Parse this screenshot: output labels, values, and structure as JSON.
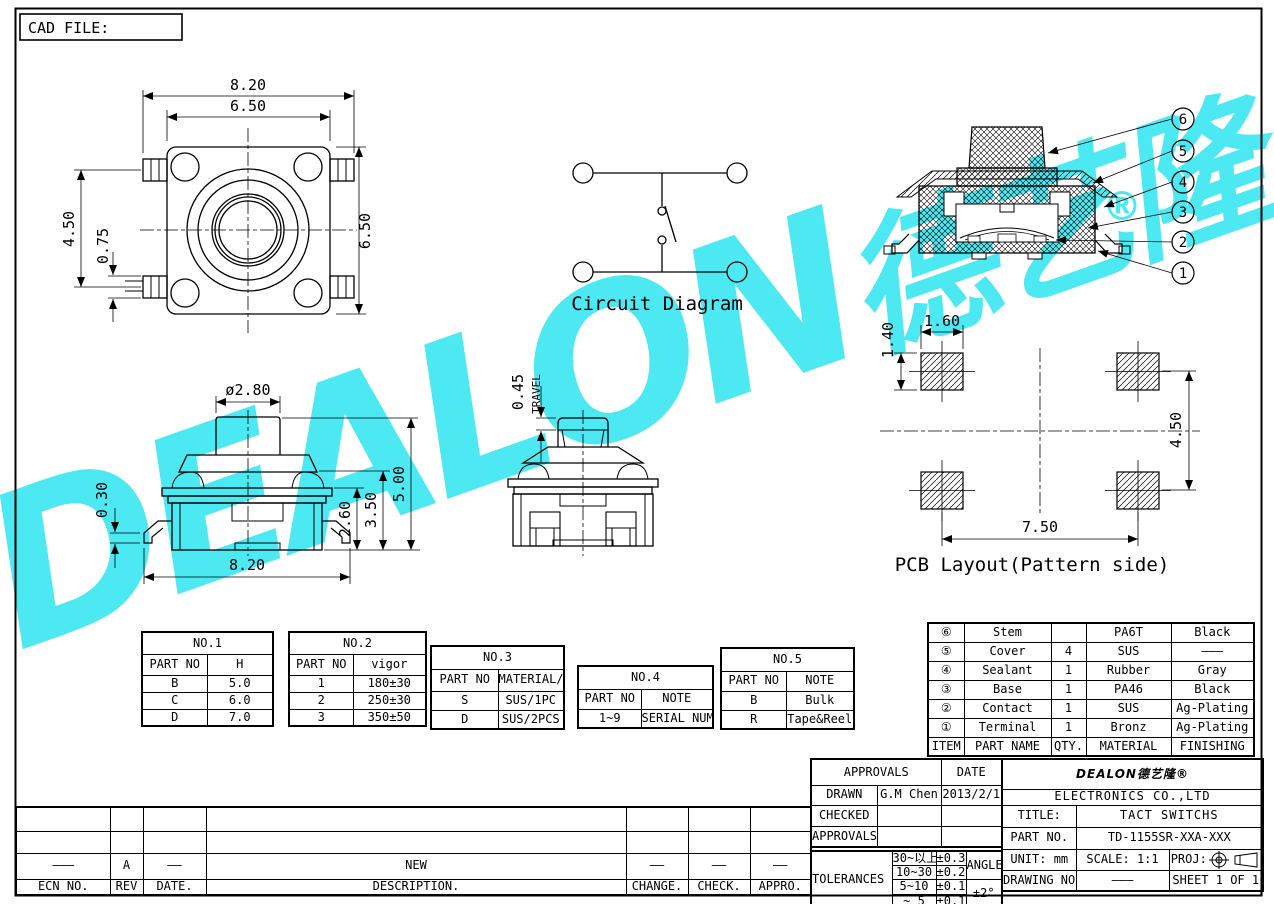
{
  "sheet": {
    "cad_file_label": "CAD FILE:"
  },
  "watermark": {
    "brand": "DEALON",
    "cjk": "德艺隆",
    "registered": "®",
    "color": "#4de9f2"
  },
  "top_view": {
    "dim_820": "8.20",
    "dim_650_top": "6.50",
    "dim_450": "4.50",
    "dim_075": "0.75",
    "dim_650_right": "6.50"
  },
  "circuit": {
    "label": "Circuit Diagram"
  },
  "section": {
    "balloons": [
      "6",
      "5",
      "4",
      "3",
      "2",
      "1"
    ]
  },
  "front_view": {
    "dim_dia": "ø2.80",
    "dim_030": "0.30",
    "dim_820": "8.20",
    "dim_260": "2.60",
    "dim_350": "3.50",
    "dim_500": "5.00"
  },
  "travel_view": {
    "dim_045": "0.45",
    "travel_label": "TRAVEL"
  },
  "pcb": {
    "label": "PCB Layout(Pattern side)",
    "dim_160": "1.60",
    "dim_140": "1.40",
    "dim_450": "4.50",
    "dim_750": "7.50"
  },
  "no1": {
    "title": "NO.1",
    "col1": "PART NO",
    "col2": "H",
    "rows": [
      [
        "B",
        "5.0"
      ],
      [
        "C",
        "6.0"
      ],
      [
        "D",
        "7.0"
      ]
    ]
  },
  "no2": {
    "title": "NO.2",
    "col1": "PART NO",
    "col2": "vigor",
    "rows": [
      [
        "1",
        "180±30"
      ],
      [
        "2",
        "250±30"
      ],
      [
        "3",
        "350±50"
      ]
    ]
  },
  "no3": {
    "title": "NO.3",
    "col1": "PART NO",
    "col2": "MATERIAL/QTY",
    "rows": [
      [
        "S",
        "SUS/1PC"
      ],
      [
        "D",
        "SUS/2PCS"
      ]
    ]
  },
  "no4": {
    "title": "NO.4",
    "col1": "PART NO",
    "col2": "NOTE",
    "rows": [
      [
        "1~9",
        "SERIAL NUMBER"
      ]
    ]
  },
  "no5": {
    "title": "NO.5",
    "col1": "PART NO",
    "col2": "NOTE",
    "rows": [
      [
        "B",
        "Bulk"
      ],
      [
        "R",
        "Tape&Reel"
      ]
    ]
  },
  "bom": {
    "rows": [
      {
        "item": "⑥",
        "name": "Stem",
        "qty": "",
        "material": "PA6T",
        "finishing": "Black"
      },
      {
        "item": "⑤",
        "name": "Cover",
        "qty": "4",
        "material": "SUS",
        "finishing": "———"
      },
      {
        "item": "④",
        "name": "Sealant",
        "qty": "1",
        "material": "Rubber",
        "finishing": "Gray"
      },
      {
        "item": "③",
        "name": "Base",
        "qty": "1",
        "material": "PA46",
        "finishing": "Black"
      },
      {
        "item": "②",
        "name": "Contact",
        "qty": "1",
        "material": "SUS",
        "finishing": "Ag-Plating"
      },
      {
        "item": "①",
        "name": "Terminal",
        "qty": "1",
        "material": "Bronz",
        "finishing": "Ag-Plating"
      }
    ],
    "footer": {
      "item": "ITEM",
      "name": "PART NAME",
      "qty": "QTY.",
      "material": "MATERIAL",
      "finishing": "FINISHING"
    }
  },
  "title_block": {
    "approvals_header": "APPROVALS",
    "date_header": "DATE",
    "drawn_label": "DRAWN",
    "drawn_name": "G.M Chen",
    "drawn_date": "2013/2/1",
    "checked_label": "CHECKED",
    "approvals_label": "APPROVALS",
    "tolerances_label": "TOLERANCES ARE",
    "tolerance_rows": [
      [
        "30~以上",
        "±0.30"
      ],
      [
        "10~30",
        "±0.20"
      ],
      [
        "5~10",
        "±0.15"
      ],
      [
        "~ 5",
        "±0.10"
      ]
    ],
    "angle_label": "ANGLE",
    "angle_value": "±2°",
    "logo": "DEALON德艺隆®",
    "company": "ELECTRONICS CO.,LTD",
    "title_label": "TITLE:",
    "title_value": "TACT SWITCHS",
    "part_no_label": "PART NO.",
    "part_no_value": "TD-1155SR-XXA-XXX",
    "unit_label": "UNIT: mm",
    "scale_label": "SCALE: 1:1",
    "proj_label": "PROJ:",
    "drawing_no_label": "DRAWING NO.",
    "drawing_no_value": "———",
    "sheet_label": "SHEET 1 OF 1"
  },
  "revision": {
    "ecn_dash": "———",
    "rev_value": "A",
    "date_dash": "——",
    "description_value": "NEW",
    "change_dash": "——",
    "check_dash": "——",
    "appro_dash": "——",
    "ecn_header": "ECN NO.",
    "rev_header": "REV",
    "date_header": "DATE.",
    "description_header": "DESCRIPTION.",
    "change_header": "CHANGE.",
    "check_header": "CHECK.",
    "appro_header": "APPRO."
  }
}
